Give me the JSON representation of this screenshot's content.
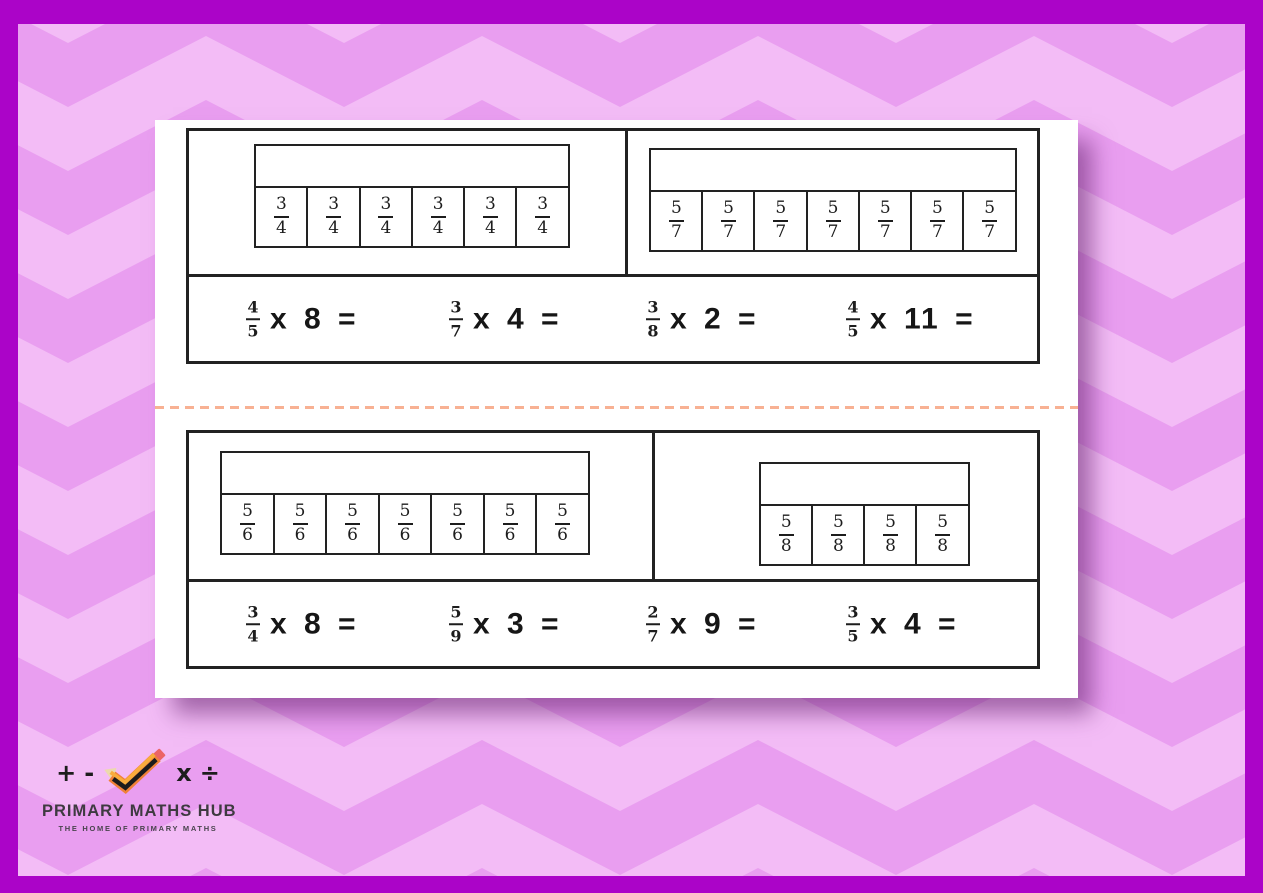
{
  "brand": {
    "title": "PRIMARY MATHS HUB",
    "tagline": "THE HOME OF PRIMARY MATHS",
    "symbols": [
      "+",
      "-",
      "x",
      "÷"
    ]
  },
  "worksheet": {
    "operator": "x",
    "equals": "=",
    "sections": [
      {
        "models": [
          {
            "num": "3",
            "den": "4",
            "count": 6
          },
          {
            "num": "5",
            "den": "7",
            "count": 7
          }
        ],
        "problems": [
          {
            "num": "4",
            "den": "5",
            "mult": "8"
          },
          {
            "num": "3",
            "den": "7",
            "mult": "4"
          },
          {
            "num": "3",
            "den": "8",
            "mult": "2"
          },
          {
            "num": "4",
            "den": "5",
            "mult": "11"
          }
        ]
      },
      {
        "models": [
          {
            "num": "5",
            "den": "6",
            "count": 7
          },
          {
            "num": "5",
            "den": "8",
            "count": 4
          }
        ],
        "problems": [
          {
            "num": "3",
            "den": "4",
            "mult": "8"
          },
          {
            "num": "5",
            "den": "9",
            "mult": "3"
          },
          {
            "num": "2",
            "den": "7",
            "mult": "9"
          },
          {
            "num": "3",
            "den": "5",
            "mult": "4"
          }
        ]
      }
    ]
  },
  "colors": {
    "frame": "#ab04c8",
    "chev_light": "#f3bcf6",
    "chev_dark": "#e99ef0",
    "ink": "#222222",
    "divider": "#f8b193",
    "logo_text": "#3e3a40"
  }
}
